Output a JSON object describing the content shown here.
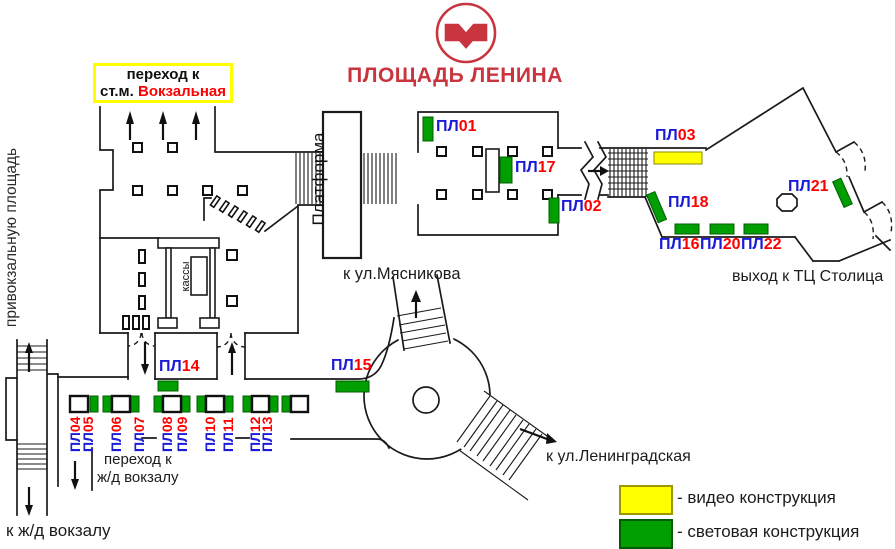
{
  "station": {
    "title": "ПЛОЩАДЬ ЛЕНИНА",
    "logo": "minsk-metro-logo"
  },
  "transfer_box": {
    "line1": "переход к",
    "line2_prefix": "ст.м.",
    "line2_station": "Вокзальная"
  },
  "labels": {
    "exit_station_square_1": "выход на",
    "exit_station_square_2": "привокзальную площадь",
    "platform": "Платформа",
    "ticket_office": "кассы",
    "to_myasnikova": "к ул.Мясникова",
    "to_leningradskaya": "к ул.Ленинградская",
    "exit_stolitsa": "выход к ТЦ Столица",
    "to_rail_transfer_1": "переход к",
    "to_rail_transfer_2": "ж/д вокзалу",
    "to_rail": "к ж/д вокзалу"
  },
  "legend": {
    "video": {
      "label": "- видео конструкция",
      "color": "#FFFF00"
    },
    "light": {
      "label": "- световая конструкция",
      "color": "#009E00"
    }
  },
  "colors": {
    "video": "#FFFF00",
    "light": "#009E00",
    "label_blue": "#1B1BD8",
    "label_red": "#FF0000",
    "brand_red": "#C8353E"
  },
  "plaques": {
    "p01": {
      "pl": "ПЛ",
      "num": "01"
    },
    "p02": {
      "pl": "ПЛ",
      "num": "02"
    },
    "p03": {
      "pl": "ПЛ",
      "num": "03"
    },
    "p04": {
      "pl": "ПЛ",
      "num": "04"
    },
    "p05": {
      "pl": "ПЛ",
      "num": "05"
    },
    "p06": {
      "pl": "ПЛ",
      "num": "06"
    },
    "p07": {
      "pl": "ПЛ",
      "num": "07"
    },
    "p08": {
      "pl": "ПЛ",
      "num": "08"
    },
    "p09": {
      "pl": "ПЛ",
      "num": "09"
    },
    "p10": {
      "pl": "ПЛ",
      "num": "10"
    },
    "p11": {
      "pl": "ПЛ",
      "num": "11"
    },
    "p12": {
      "pl": "ПЛ",
      "num": "12"
    },
    "p13": {
      "pl": "ПЛ",
      "num": "13"
    },
    "p14": {
      "pl": "ПЛ",
      "num": "14"
    },
    "p15": {
      "pl": "ПЛ",
      "num": "15"
    },
    "p16": {
      "pl": "ПЛ",
      "num": "16"
    },
    "p17": {
      "pl": "ПЛ",
      "num": "17"
    },
    "p18": {
      "pl": "ПЛ",
      "num": "18"
    },
    "p20": {
      "pl": "ПЛ",
      "num": "20"
    },
    "p21": {
      "pl": "ПЛ",
      "num": "21"
    },
    "p22": {
      "pl": "ПЛ",
      "num": "22"
    }
  }
}
